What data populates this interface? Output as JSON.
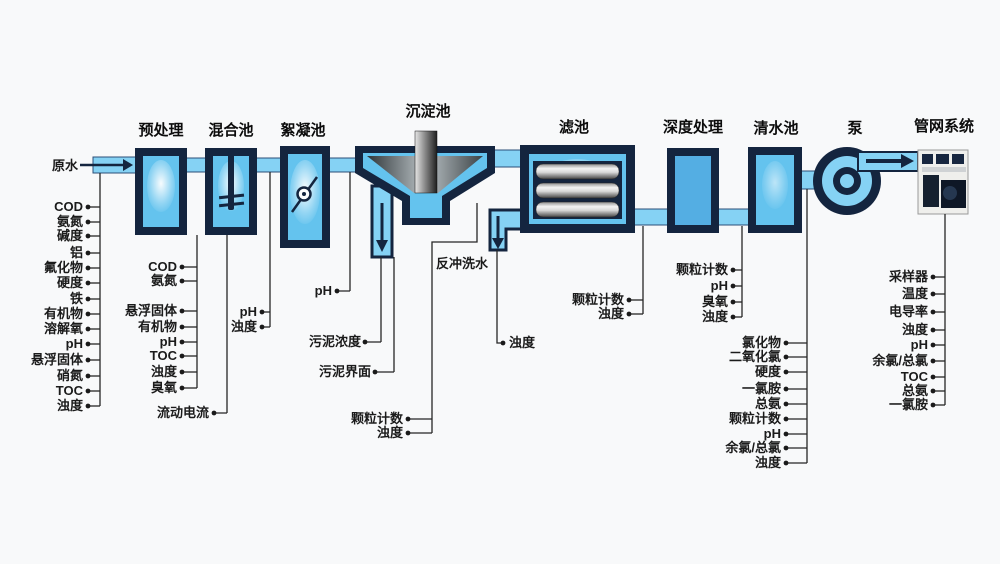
{
  "titles": {
    "pretreatment": "预处理",
    "mixing": "混合池",
    "flocculation": "絮凝池",
    "sedimentation": "沉淀池",
    "filter": "滤池",
    "advanced": "深度处理",
    "clearwater": "清水池",
    "pump": "泵",
    "network": "管网系统"
  },
  "labels": {
    "raw_water": "原水",
    "streaming_current": "流动电流",
    "flocculation_ph": "pH",
    "sludge_concentration": "污泥浓度",
    "sludge_interface": "污泥界面",
    "backwash_water": "反冲洗水",
    "backwash_turbidity": "浊度"
  },
  "clusters": {
    "raw_water": [
      "COD",
      "氨氮",
      "碱度",
      "铝",
      "氟化物",
      "硬度",
      "铁",
      "有机物",
      "溶解氧",
      "pH",
      "悬浮固体",
      "硝氮",
      "TOC",
      "浊度"
    ],
    "pretreatment": [
      "COD",
      "氨氮",
      "悬浮固体",
      "有机物",
      "pH",
      "TOC",
      "浊度",
      "臭氧"
    ],
    "mixing": [
      "pH",
      "浊度"
    ],
    "settled_water": [
      "颗粒计数",
      "浊度"
    ],
    "filter": [
      "颗粒计数",
      "浊度"
    ],
    "advanced": [
      "颗粒计数",
      "pH",
      "臭氧",
      "浊度"
    ],
    "clearwater": [
      "氯化物",
      "二氧化氯",
      "硬度",
      "一氯胺",
      "总氨",
      "颗粒计数",
      "pH",
      "余氯/总氯",
      "浊度"
    ],
    "network": [
      "采样器",
      "温度",
      "电导率",
      "浊度",
      "pH",
      "余氯/总氯",
      "TOC",
      "总氨",
      "一氯胺"
    ]
  },
  "colors": {
    "navy": "#14253f",
    "tank_blue": "#64c3ee",
    "pipe_blue": "#85d2f4",
    "deep_blue": "#54aee3",
    "background": "#f8f9fa"
  }
}
